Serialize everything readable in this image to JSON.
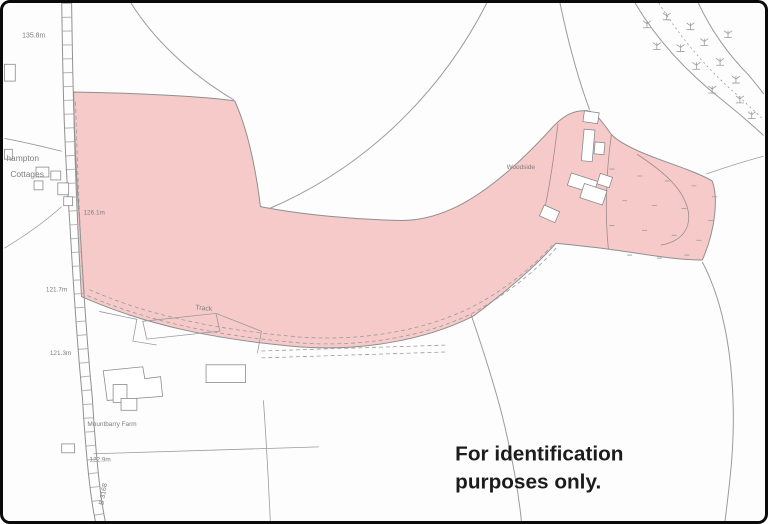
{
  "map": {
    "type": "location-plan",
    "disclaimer": {
      "line1": "For identification",
      "line2": "purposes only."
    },
    "labels": {
      "spot_height_top": "135.8m",
      "cottages_line1": "hampton",
      "cottages_line2": "Cottages",
      "spot_height_upper": "126.1m",
      "spot_height_mid": "121.7m",
      "spot_height_lower": "121.3m",
      "track": "Track",
      "woodside": "Woodside",
      "farm": "Mountbarry Farm",
      "spot_height_bottom": "122.9m",
      "road_number": "B 3168"
    },
    "colors": {
      "highlight_fill": "#f7caca",
      "highlight_outline": "#8f8f8f",
      "field_line": "#9a9a9a",
      "label_text": "#7d7d7d",
      "disclaimer_text": "#1c1c1c",
      "background": "#fdfdfd",
      "frame_border": "#0a0a0a"
    },
    "symbols": {
      "tree": "tree-scrub-symbol",
      "rough_grass": "rough-grass-dash-symbol"
    }
  }
}
